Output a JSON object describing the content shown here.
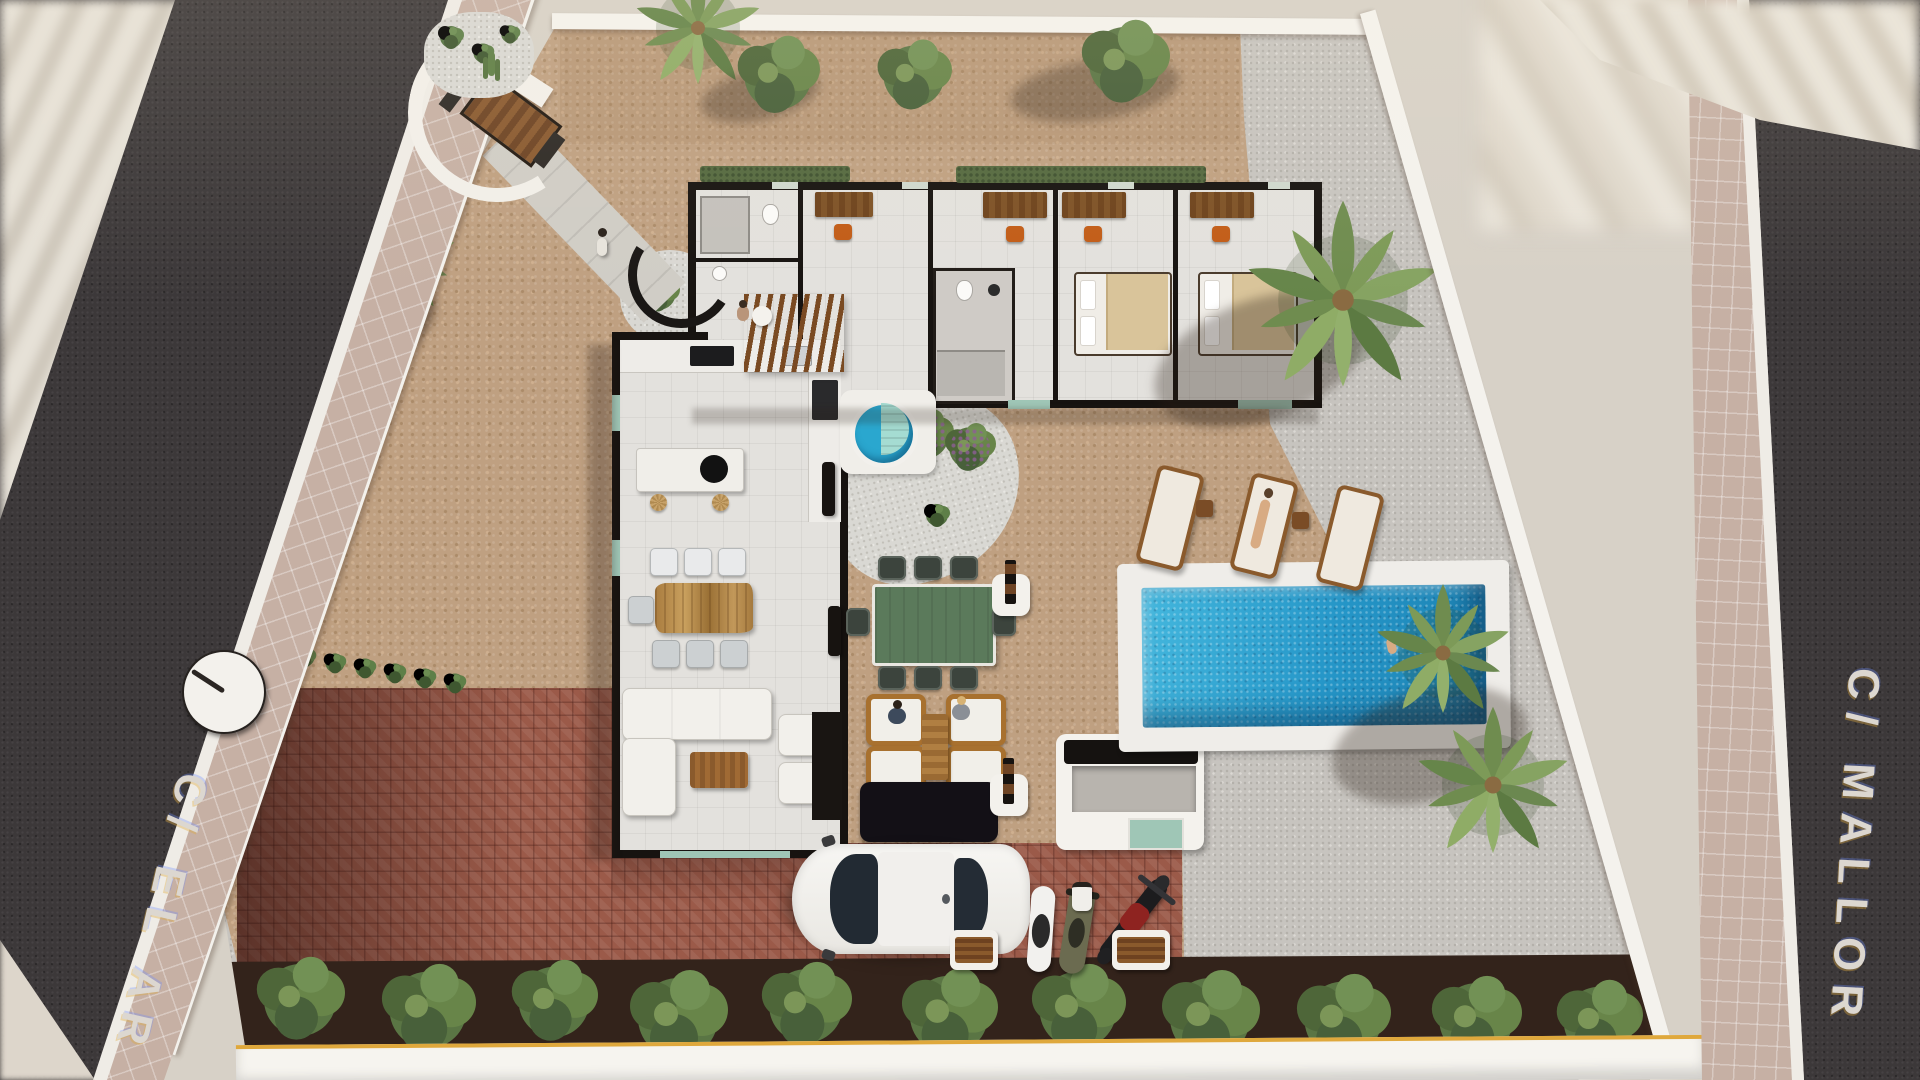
{
  "streets": {
    "left": {
      "label": "C/ EL AR"
    },
    "right": {
      "label": "C/ MALLOR"
    }
  },
  "icons": {
    "compass": "white disc street marker with single dark hand"
  },
  "palette": {
    "asphalt": "#3c3839",
    "sidewalk_tile": "#c6b0a4",
    "terrace_cobble": "#bfa081",
    "gravel": "#c7c4bf",
    "white_gravel": "#d9d8d3",
    "brick_driveway": "#9b5a49",
    "mulch_bed": "#33231b",
    "pool_water": "#2596c8",
    "jacuzzi_water": "#2aa7cf",
    "perimeter_wall": "#f4f2ed",
    "cut_wall": "#171310",
    "street_text": "#dcd7d0",
    "sunlit_wall_edge": "#dfa83c",
    "desk_wood": "#7e5226",
    "chair_orange": "#c25c17",
    "greenery": "#5d7a44"
  }
}
